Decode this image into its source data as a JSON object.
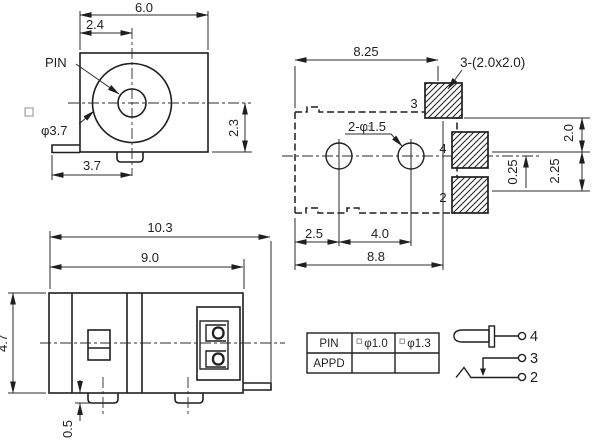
{
  "front_view": {
    "pin_label": "PIN",
    "dims": {
      "width": "6.0",
      "pin_offset": "2.4",
      "barrel_diameter": "φ3.7",
      "center_to_bottom": "2.3",
      "tab_width": "3.7"
    }
  },
  "footprint_view": {
    "dims": {
      "top_width": "8.25",
      "pad_size_note": "3-(2.0x2.0)",
      "holes_note": "2-φ1.5",
      "hole_offset": "2.5",
      "hole_pitch": "4.0",
      "bottom_width": "8.8",
      "pad_gap": "2.0",
      "center_offset": "0.25",
      "pad_pitch": "2.25"
    },
    "pad_labels": {
      "pad3": "3",
      "pad4": "4",
      "pad2": "2"
    }
  },
  "side_view": {
    "dims": {
      "overall_width": "10.3",
      "body_width": "9.0",
      "height": "4.7",
      "boss_height": "0.5"
    }
  },
  "spec_table": {
    "rows": [
      [
        "PIN",
        "φ1.0",
        "φ1.3"
      ],
      [
        "APPD",
        "",
        ""
      ]
    ]
  },
  "schematic": {
    "terminal_4": "4",
    "terminal_3": "3",
    "terminal_2": "2"
  }
}
